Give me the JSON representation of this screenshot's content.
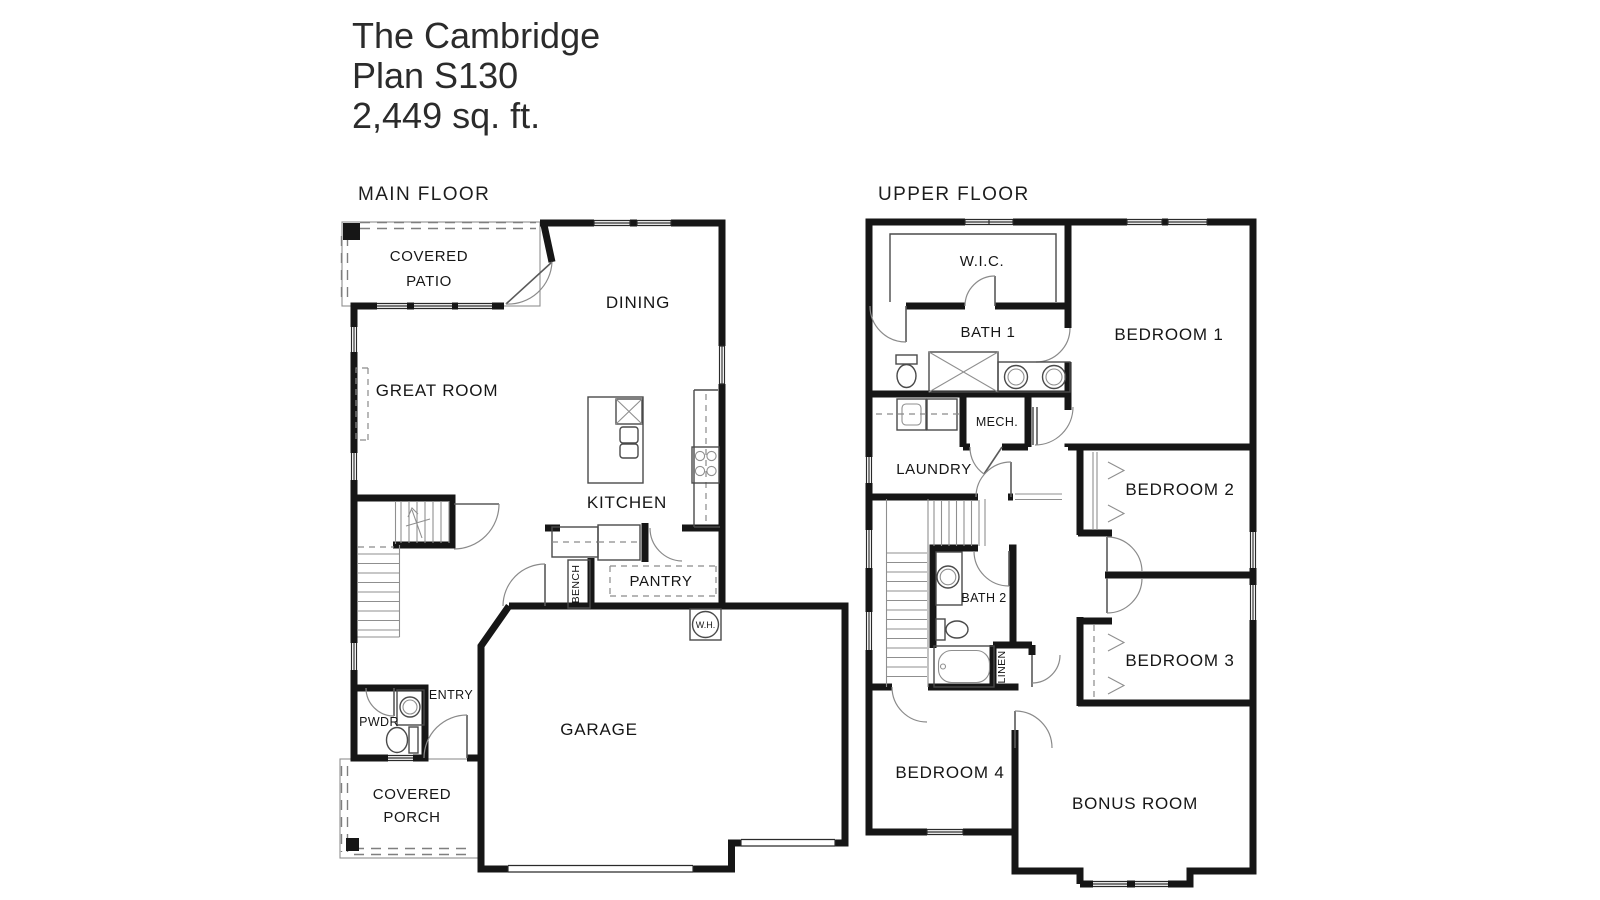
{
  "title": {
    "name": "The Cambridge",
    "plan": "Plan S130",
    "sqft": "2,449 sq. ft."
  },
  "floors": {
    "main": {
      "label": "MAIN FLOOR",
      "rooms": {
        "covered_patio_line1": "COVERED",
        "covered_patio_line2": "PATIO",
        "dining": "DINING",
        "great_room": "GREAT ROOM",
        "kitchen": "KITCHEN",
        "pantry": "PANTRY",
        "bench": "BENCH",
        "water_heater": "W.H.",
        "entry": "ENTRY",
        "powder": "PWDR",
        "garage": "GARAGE",
        "covered_porch_line1": "COVERED",
        "covered_porch_line2": "PORCH"
      }
    },
    "upper": {
      "label": "UPPER FLOOR",
      "rooms": {
        "wic": "W.I.C.",
        "bath1": "BATH 1",
        "bedroom1": "BEDROOM 1",
        "mech": "MECH.",
        "laundry": "LAUNDRY",
        "bedroom2": "BEDROOM 2",
        "bath2": "BATH 2",
        "linen": "LINEN",
        "bedroom3": "BEDROOM 3",
        "bedroom4": "BEDROOM 4",
        "bonus": "BONUS ROOM"
      }
    }
  },
  "colors": {
    "background": "#ffffff",
    "wall": "#161616",
    "fixture_line": "#4a4a4a",
    "light_line": "#8f8f8f",
    "text": "#161616",
    "title_text": "#2b2b2b"
  }
}
